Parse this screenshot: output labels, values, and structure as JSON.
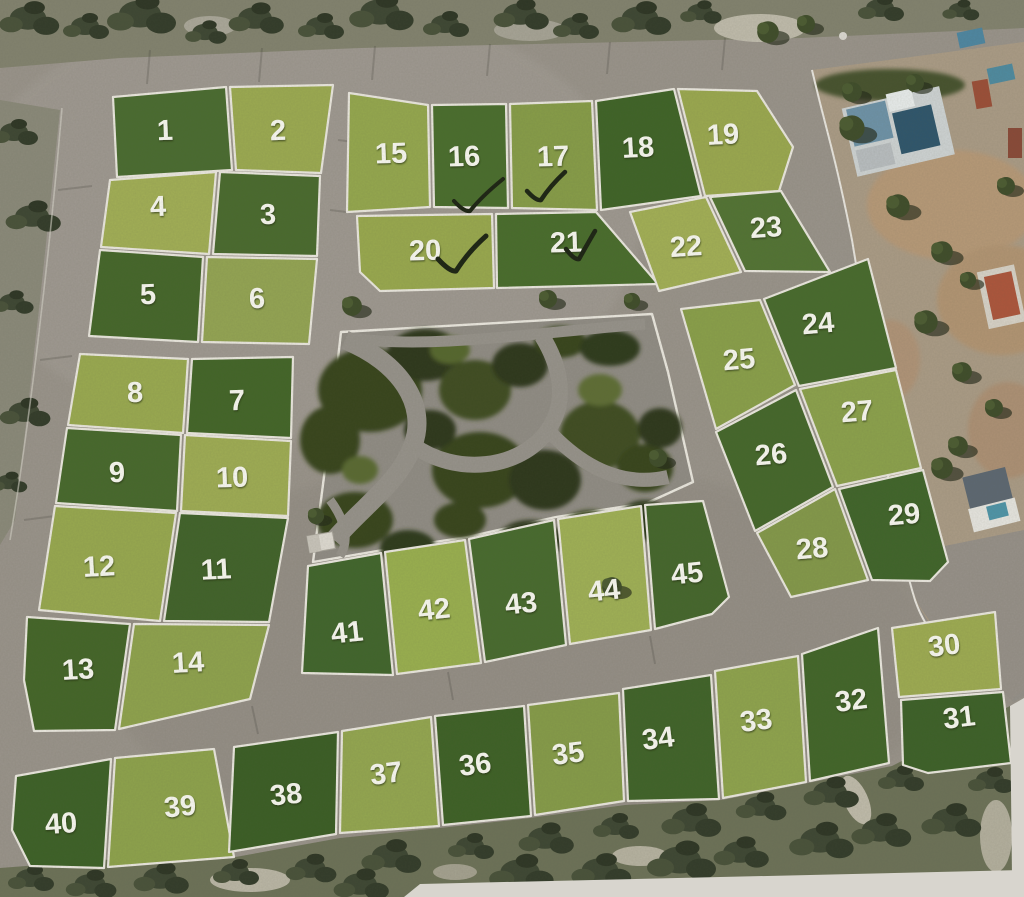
{
  "map": {
    "kind": "aerial land subdivision plot plan",
    "total_plots": 45,
    "checked_plots": [
      "16",
      "17",
      "20",
      "21"
    ],
    "checkmark_symbol": "✓"
  },
  "colors": {
    "road": "#9a948b",
    "park_path": "#918d85",
    "scrub_top": "#83836f",
    "scrub_left": "#8b8a7a",
    "scrub_bottom": "#6d7258",
    "dirt": "#ab9c86",
    "curb": "#ece9e0",
    "label_text": "#fafaf2",
    "checkmark_ink": "#1c2413",
    "plot_light_green": "#9aaa50",
    "plot_dark_green": "#47672e",
    "park_vegetation": "#38451f",
    "paper_edge": "#d8d5ce"
  },
  "plots": [
    {
      "label": "1",
      "color": "#4a6c30",
      "checked": false
    },
    {
      "label": "2",
      "color": "#9cab51",
      "checked": false
    },
    {
      "label": "3",
      "color": "#4a6b2e",
      "checked": false
    },
    {
      "label": "4",
      "color": "#a2af56",
      "checked": false
    },
    {
      "label": "5",
      "color": "#45672a",
      "checked": false
    },
    {
      "label": "6",
      "color": "#94a553",
      "checked": false
    },
    {
      "label": "7",
      "color": "#436628",
      "checked": false
    },
    {
      "label": "8",
      "color": "#9aaa50",
      "checked": false
    },
    {
      "label": "9",
      "color": "#47692c",
      "checked": false
    },
    {
      "label": "10",
      "color": "#9fad54",
      "checked": false
    },
    {
      "label": "11",
      "color": "#41632a",
      "checked": false
    },
    {
      "label": "12",
      "color": "#98a94f",
      "checked": false
    },
    {
      "label": "13",
      "color": "#446628",
      "checked": false
    },
    {
      "label": "14",
      "color": "#8fa34d",
      "checked": false
    },
    {
      "label": "15",
      "color": "#95a84e",
      "checked": false
    },
    {
      "label": "16",
      "color": "#4a6e2d",
      "checked": true
    },
    {
      "label": "17",
      "color": "#879d48",
      "checked": true
    },
    {
      "label": "18",
      "color": "#3f6427",
      "checked": false
    },
    {
      "label": "19",
      "color": "#9ba94f",
      "checked": false
    },
    {
      "label": "20",
      "color": "#99a94e",
      "checked": true
    },
    {
      "label": "21",
      "color": "#496d2c",
      "checked": true
    },
    {
      "label": "22",
      "color": "#a3b056",
      "checked": false
    },
    {
      "label": "23",
      "color": "#537434",
      "checked": false
    },
    {
      "label": "24",
      "color": "#486b2d",
      "checked": false
    },
    {
      "label": "25",
      "color": "#8aa04a",
      "checked": false
    },
    {
      "label": "26",
      "color": "#45682b",
      "checked": false
    },
    {
      "label": "27",
      "color": "#8ca24c",
      "checked": false
    },
    {
      "label": "28",
      "color": "#84994a",
      "checked": false
    },
    {
      "label": "29",
      "color": "#40652a",
      "checked": false
    },
    {
      "label": "30",
      "color": "#9eac52",
      "checked": false
    },
    {
      "label": "31",
      "color": "#3d6128",
      "checked": false
    },
    {
      "label": "32",
      "color": "#426629",
      "checked": false
    },
    {
      "label": "33",
      "color": "#8fa44d",
      "checked": false
    },
    {
      "label": "34",
      "color": "#406429",
      "checked": false
    },
    {
      "label": "35",
      "color": "#869c49",
      "checked": false
    },
    {
      "label": "36",
      "color": "#3e6126",
      "checked": false
    },
    {
      "label": "37",
      "color": "#94a750",
      "checked": false
    },
    {
      "label": "38",
      "color": "#3b5e25",
      "checked": false
    },
    {
      "label": "39",
      "color": "#8ea34c",
      "checked": false
    },
    {
      "label": "40",
      "color": "#3d6127",
      "checked": false
    },
    {
      "label": "41",
      "color": "#41662c",
      "checked": false
    },
    {
      "label": "42",
      "color": "#9ab04f",
      "checked": false
    },
    {
      "label": "43",
      "color": "#486b2e",
      "checked": false
    },
    {
      "label": "44",
      "color": "#a0b156",
      "checked": false
    },
    {
      "label": "45",
      "color": "#45672c",
      "checked": false
    }
  ]
}
